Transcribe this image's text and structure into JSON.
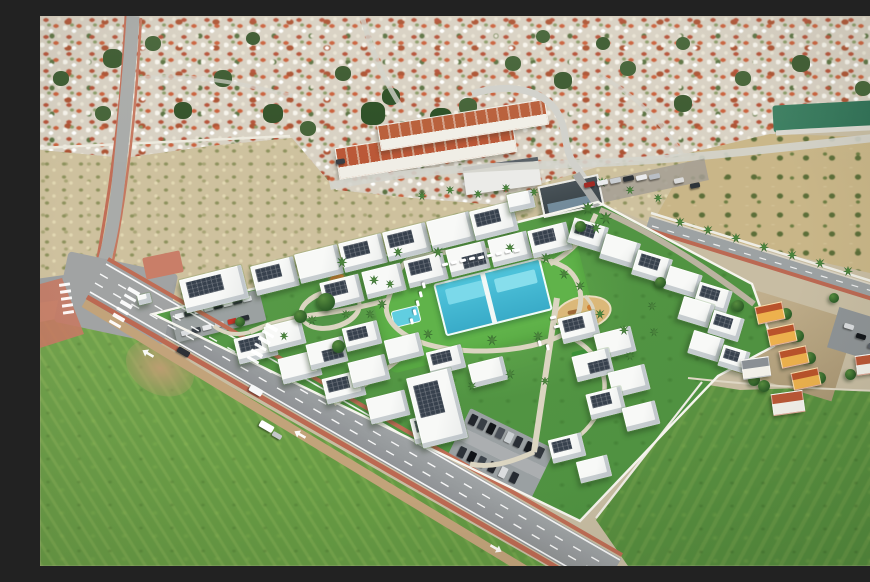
{
  "meta": {
    "title": "Aerial drone view of a new-build white residential complex with communal pool, lawns and parking, surrounded by a Spanish town, scrubland and green fields",
    "image_width": 870,
    "image_height": 550,
    "approx_building_count": 46,
    "no_visible_text": true
  },
  "palette": {
    "town_base": "#d6cfc2",
    "scrub": "#ccc09f",
    "grove": "#c7b58a",
    "water_lagoon": "#2d6b52",
    "field_green": "#699a48",
    "lawn": "#559447",
    "lawn_bright": "#63b14f",
    "pool_water": "#3fa9c4",
    "pool_light": "#7fd6e6",
    "building_white": "#f6f7f5",
    "solar_panel": "#39424d",
    "roof_terracotta": "#b5593a",
    "road_asphalt": "#8f9294",
    "sidewalk_red": "#c27b66",
    "path_beige": "#d9d3c1",
    "sand": "#d8b77c",
    "tree_green": "#2c5a2a",
    "wall_white": "#f4f3ec"
  },
  "scene": {
    "regions": [
      "dense-town-background-top",
      "terracotta-townhouse-rows",
      "green-lagoon-top-right",
      "olive-grove-right",
      "scrubland-band",
      "new-build-complex-center",
      "communal-pool-and-lawn",
      "sand-playground",
      "left-parking-lot",
      "bottom-parking-lot",
      "main-road-bottom-left-with-crosswalks",
      "palm-lined-road-right",
      "green-field-bottom-left",
      "green-field-bottom-right",
      "orange-townhouses-right-edge"
    ],
    "buildings": [
      [
        142,
        256,
        64,
        34,
        -14,
        1
      ],
      [
        213,
        245,
        44,
        30,
        -14,
        1
      ],
      [
        257,
        233,
        44,
        30,
        -14,
        0
      ],
      [
        301,
        222,
        44,
        30,
        -14,
        1
      ],
      [
        345,
        211,
        44,
        30,
        -14,
        1
      ],
      [
        389,
        200,
        44,
        30,
        -14,
        0
      ],
      [
        432,
        190,
        44,
        30,
        -14,
        1
      ],
      [
        282,
        262,
        40,
        28,
        -14,
        1
      ],
      [
        324,
        251,
        40,
        28,
        -14,
        0
      ],
      [
        366,
        240,
        40,
        28,
        -14,
        1
      ],
      [
        408,
        229,
        40,
        28,
        -14,
        2
      ],
      [
        450,
        219,
        40,
        28,
        -14,
        0
      ],
      [
        490,
        210,
        40,
        28,
        -14,
        1
      ],
      [
        530,
        206,
        36,
        26,
        17,
        1
      ],
      [
        562,
        222,
        36,
        26,
        17,
        0
      ],
      [
        594,
        238,
        36,
        26,
        17,
        1
      ],
      [
        626,
        254,
        34,
        24,
        17,
        0
      ],
      [
        656,
        270,
        34,
        24,
        17,
        1
      ],
      [
        640,
        284,
        32,
        24,
        17,
        0
      ],
      [
        670,
        298,
        32,
        24,
        17,
        1
      ],
      [
        650,
        318,
        32,
        24,
        17,
        0
      ],
      [
        680,
        332,
        28,
        22,
        17,
        1
      ],
      [
        196,
        318,
        40,
        26,
        -14,
        1
      ],
      [
        240,
        338,
        40,
        26,
        -14,
        0
      ],
      [
        284,
        358,
        40,
        26,
        -14,
        1
      ],
      [
        328,
        378,
        40,
        26,
        -14,
        0
      ],
      [
        372,
        398,
        40,
        26,
        -14,
        1
      ],
      [
        226,
        306,
        38,
        26,
        -14,
        0
      ],
      [
        268,
        324,
        38,
        26,
        -14,
        2
      ],
      [
        310,
        342,
        38,
        26,
        -14,
        0
      ],
      [
        304,
        308,
        36,
        24,
        -14,
        1
      ],
      [
        346,
        320,
        36,
        24,
        -14,
        0
      ],
      [
        388,
        332,
        36,
        24,
        -14,
        1
      ],
      [
        430,
        344,
        36,
        24,
        -14,
        0
      ],
      [
        374,
        356,
        46,
        72,
        -14,
        1
      ],
      [
        520,
        298,
        38,
        26,
        -14,
        1
      ],
      [
        556,
        314,
        38,
        26,
        -14,
        0
      ],
      [
        534,
        336,
        38,
        26,
        -14,
        2
      ],
      [
        570,
        352,
        38,
        26,
        -14,
        0
      ],
      [
        548,
        374,
        36,
        26,
        -14,
        1
      ],
      [
        584,
        388,
        34,
        24,
        -14,
        0
      ],
      [
        510,
        420,
        34,
        24,
        -14,
        1
      ],
      [
        538,
        442,
        32,
        22,
        -14,
        0
      ],
      [
        468,
        176,
        26,
        18,
        -12,
        0
      ],
      [
        98,
        278,
        13,
        10,
        -14,
        0
      ]
    ],
    "palms": [
      [
        302,
        246,
        11
      ],
      [
        334,
        264,
        10
      ],
      [
        358,
        236,
        10
      ],
      [
        398,
        236,
        11
      ],
      [
        470,
        232,
        10
      ],
      [
        506,
        242,
        11
      ],
      [
        524,
        258,
        10
      ],
      [
        540,
        270,
        10
      ],
      [
        350,
        268,
        9
      ],
      [
        342,
        288,
        10
      ],
      [
        388,
        318,
        10
      ],
      [
        452,
        324,
        11
      ],
      [
        498,
        320,
        10
      ],
      [
        306,
        298,
        9
      ],
      [
        272,
        304,
        10
      ],
      [
        244,
        320,
        9
      ],
      [
        560,
        298,
        10
      ],
      [
        584,
        314,
        10
      ],
      [
        612,
        290,
        9
      ],
      [
        470,
        358,
        10
      ],
      [
        432,
        370,
        9
      ],
      [
        330,
        298,
        9
      ],
      [
        614,
        316,
        9
      ],
      [
        590,
        340,
        9
      ],
      [
        505,
        365,
        9
      ],
      [
        548,
        192,
        13
      ],
      [
        566,
        202,
        13
      ],
      [
        556,
        212,
        11
      ],
      [
        382,
        180,
        9
      ],
      [
        410,
        174,
        9
      ],
      [
        438,
        178,
        9
      ],
      [
        466,
        172,
        9
      ],
      [
        494,
        176,
        9
      ],
      [
        562,
        166,
        10
      ],
      [
        590,
        174,
        9
      ],
      [
        618,
        182,
        9
      ],
      [
        640,
        206,
        10
      ],
      [
        668,
        214,
        10
      ],
      [
        696,
        222,
        10
      ],
      [
        724,
        231,
        10
      ],
      [
        752,
        239,
        10
      ],
      [
        780,
        247,
        10
      ],
      [
        808,
        255,
        10
      ],
      [
        836,
        264,
        10
      ],
      [
        862,
        271,
        9
      ]
    ],
    "trees": [
      [
        286,
        286,
        18
      ],
      [
        260,
        300,
        13
      ],
      [
        540,
        210,
        11
      ],
      [
        298,
        330,
        13
      ],
      [
        620,
        266,
        11
      ],
      [
        200,
        306,
        10
      ],
      [
        698,
        290,
        12
      ],
      [
        714,
        364,
        12
      ],
      [
        746,
        298,
        12
      ],
      [
        758,
        320,
        12
      ],
      [
        770,
        342,
        12
      ],
      [
        780,
        362,
        12
      ],
      [
        724,
        370,
        12
      ],
      [
        810,
        358,
        11
      ],
      [
        838,
        354,
        11
      ],
      [
        860,
        340,
        11
      ],
      [
        864,
        300,
        10
      ],
      [
        794,
        282,
        10
      ],
      [
        866,
        252,
        10
      ]
    ],
    "loungers": [
      [
        402,
        247,
        -14
      ],
      [
        411,
        245,
        -14
      ],
      [
        420,
        243,
        -14
      ],
      [
        429,
        241,
        -14
      ],
      [
        438,
        240,
        -14
      ],
      [
        447,
        238,
        -14
      ],
      [
        456,
        236,
        -14
      ],
      [
        465,
        234,
        -14
      ],
      [
        474,
        233,
        -14
      ],
      [
        381,
        268,
        76
      ],
      [
        378,
        277,
        76
      ],
      [
        375,
        286,
        76
      ],
      [
        372,
        295,
        76
      ],
      [
        369,
        304,
        76
      ],
      [
        510,
        300,
        -14
      ],
      [
        514,
        309,
        -14
      ],
      [
        497,
        326,
        76
      ],
      [
        505,
        330,
        76
      ]
    ],
    "vehicles": [
      [
        137,
        333,
        "#2e3237",
        30,
        13,
        6
      ],
      [
        209,
        371,
        "#f4f5f6",
        30,
        14,
        7
      ],
      [
        219,
        407,
        "#fdfdfd",
        30,
        15,
        7
      ],
      [
        232,
        417,
        "#c4c6c8",
        30,
        10,
        5
      ],
      [
        838,
        281,
        "#eef0f1",
        17,
        11,
        5
      ],
      [
        296,
        143,
        "#3a3e44",
        -9,
        9,
        5
      ],
      [
        544,
        166,
        "#9c2d27",
        -12,
        11,
        5
      ],
      [
        557,
        164,
        "#e9eaeb",
        -12,
        11,
        5
      ],
      [
        570,
        162,
        "#c9ccd0",
        -12,
        11,
        5
      ],
      [
        583,
        160,
        "#2e3338",
        -12,
        11,
        5
      ],
      [
        596,
        159,
        "#e8e9eb",
        -12,
        11,
        5
      ],
      [
        609,
        158,
        "#b8bdc2",
        -12,
        11,
        5
      ],
      [
        634,
        162,
        "#d9d9d9",
        -12,
        10,
        5
      ],
      [
        650,
        167,
        "#30353b",
        -12,
        10,
        5
      ],
      [
        804,
        308,
        "#d8dadc",
        17,
        10,
        5
      ],
      [
        816,
        318,
        "#15181c",
        17,
        10,
        5
      ],
      [
        828,
        328,
        "#5a6066",
        17,
        10,
        5
      ]
    ],
    "parking_left_cars": [
      [
        4,
        4,
        "#eceef0"
      ],
      [
        14,
        4,
        "#2f353b"
      ],
      [
        24,
        4,
        "#e2e4e6"
      ],
      [
        34,
        4,
        "#c8cdd1"
      ],
      [
        44,
        4,
        "#23282e"
      ],
      [
        54,
        4,
        "#eef0f1"
      ],
      [
        64,
        4,
        "#31363c"
      ],
      [
        74,
        4,
        "#d8dbde"
      ],
      [
        6,
        22,
        "#d8dbde"
      ],
      [
        17,
        22,
        "#3a4046"
      ],
      [
        28,
        22,
        "#e6e8ea"
      ],
      [
        41,
        22,
        "#caccd0"
      ],
      [
        54,
        22,
        "#c0392e"
      ],
      [
        67,
        22,
        "#2a2f35"
      ]
    ],
    "parking_bottom_cars": [
      [
        4,
        4,
        "#24282d"
      ],
      [
        14,
        4,
        "#3a4047"
      ],
      [
        24,
        4,
        "#14171b"
      ],
      [
        34,
        4,
        "#4a5057"
      ],
      [
        44,
        4,
        "#c9cdd0"
      ],
      [
        54,
        4,
        "#2c3137"
      ],
      [
        66,
        4,
        "#191d22"
      ],
      [
        78,
        4,
        "#34383e"
      ],
      [
        8,
        38,
        "#2f343a"
      ],
      [
        19,
        38,
        "#111418"
      ],
      [
        30,
        38,
        "#3f454c"
      ],
      [
        42,
        38,
        "#22262b"
      ],
      [
        54,
        38,
        "#d8dadc"
      ],
      [
        66,
        38,
        "#282d33"
      ]
    ],
    "zebras": [
      {
        "cx": 28,
        "cy": 282,
        "rot": 82,
        "n": 5,
        "bw": 3,
        "bh": 11,
        "gap": 4
      },
      {
        "cx": 86,
        "cy": 291,
        "rot": 120,
        "n": 6,
        "bw": 3.5,
        "bh": 13,
        "gap": 4
      },
      {
        "cx": 224,
        "cy": 327,
        "rot": 120,
        "n": 6,
        "bw": 3.5,
        "bh": 13,
        "gap": 4
      }
    ],
    "arrows": [
      [
        256,
        412,
        300
      ],
      [
        452,
        526,
        120
      ],
      [
        104,
        331,
        300
      ]
    ],
    "orange_houses": [
      [
        716,
        288
      ],
      [
        728,
        310
      ],
      [
        740,
        332
      ],
      [
        752,
        354
      ]
    ],
    "white_houses": [
      [
        702,
        342,
        26,
        18,
        "#8a8f93"
      ],
      [
        732,
        376,
        30,
        20,
        "#b5593a"
      ],
      [
        816,
        338,
        26,
        18,
        "#b5593a"
      ],
      [
        842,
        328,
        26,
        18,
        "#a94e32"
      ],
      [
        848,
        352,
        24,
        16,
        "#b5593a"
      ]
    ]
  }
}
